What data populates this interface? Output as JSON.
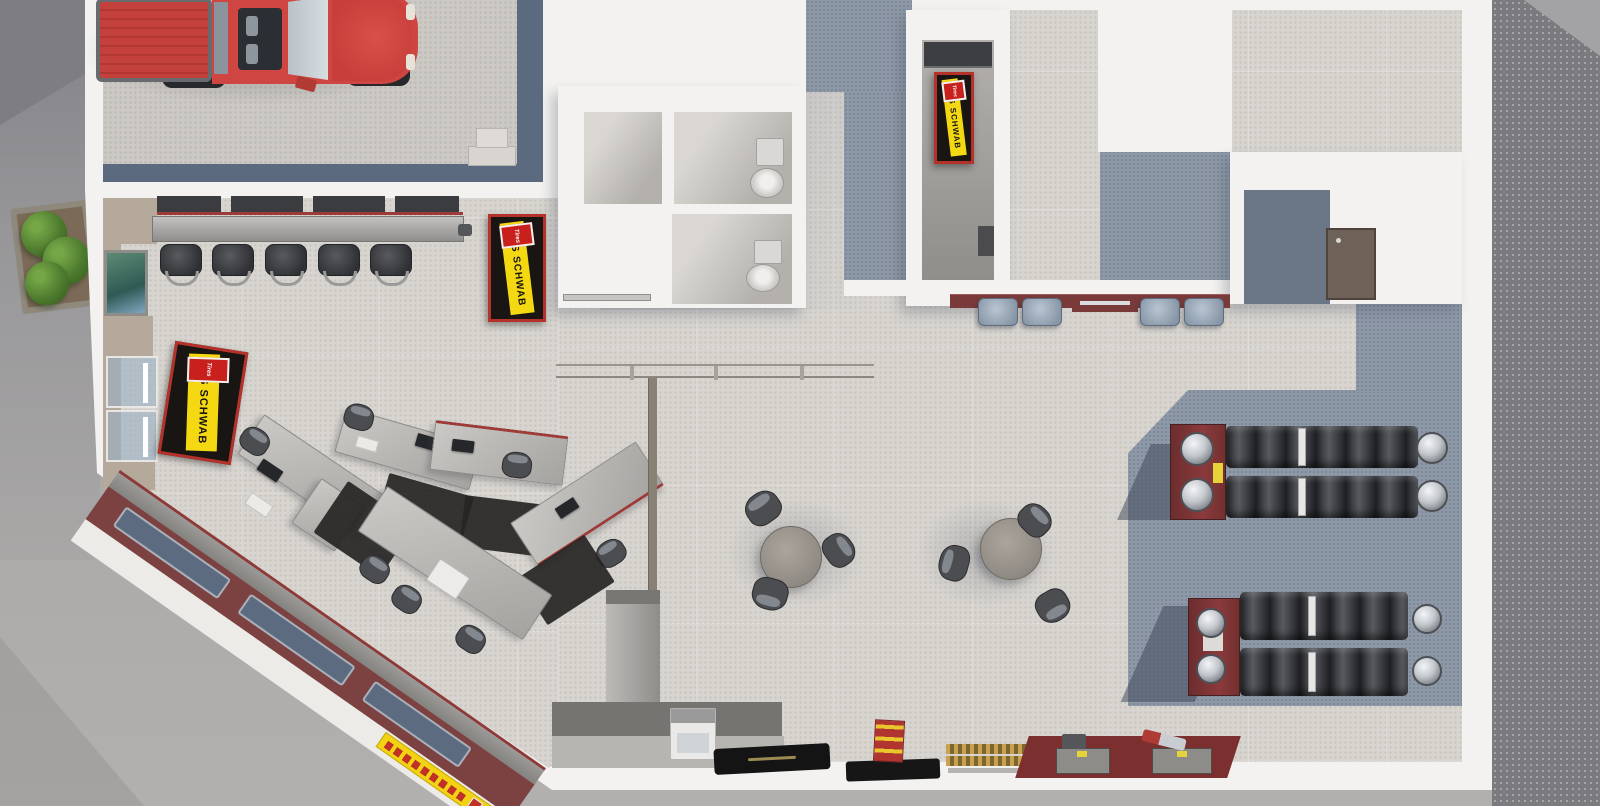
{
  "scene": {
    "description": "Top-down 3D rendering of a Les Schwab tire center interior"
  },
  "branding": {
    "brand": "LES SCHWAB",
    "logo": "Tires",
    "brand_yellow": "#f4d912",
    "brand_red": "#c8201d",
    "sign_black": "#181512"
  },
  "signs": {
    "entry_floor_mat": "LES SCHWAB",
    "showroom_sign": "LES SCHWAB",
    "hallway_mat": "LES SCHWAB"
  },
  "palette": {
    "asphalt": "#7b7a7e",
    "sidewalk": "#aaa8a6",
    "building_wall": "#f3f2f0",
    "showroom_floor": "#d8d5d0",
    "carpet_blue_gray": "#8e99a8",
    "garage_band_blue": "#5c6a80",
    "walkway_red": "#7c4241",
    "bench_maroon": "#7a3a3a",
    "tire_rack_maroon": "#7c3336",
    "truck_red": "#cf4541",
    "wall_tan": "#b4a99b"
  },
  "inventory": {
    "vehicles": [
      {
        "name": "red pickup truck",
        "location": "service bay"
      }
    ],
    "counter_stools": 5,
    "sales_desks": 5,
    "round_tables": 2,
    "chairs_per_table": 3,
    "bench_cushions": 4,
    "tire_racks": 2,
    "toilets": 2,
    "entry_doors": 2,
    "branded_signs": 3
  },
  "areas": [
    {
      "name": "service bay"
    },
    {
      "name": "entry vestibule"
    },
    {
      "name": "showroom"
    },
    {
      "name": "sales desk arc"
    },
    {
      "name": "waiting tables"
    },
    {
      "name": "restrooms"
    },
    {
      "name": "hallway"
    },
    {
      "name": "tire display"
    },
    {
      "name": "rear entry alcove"
    }
  ]
}
